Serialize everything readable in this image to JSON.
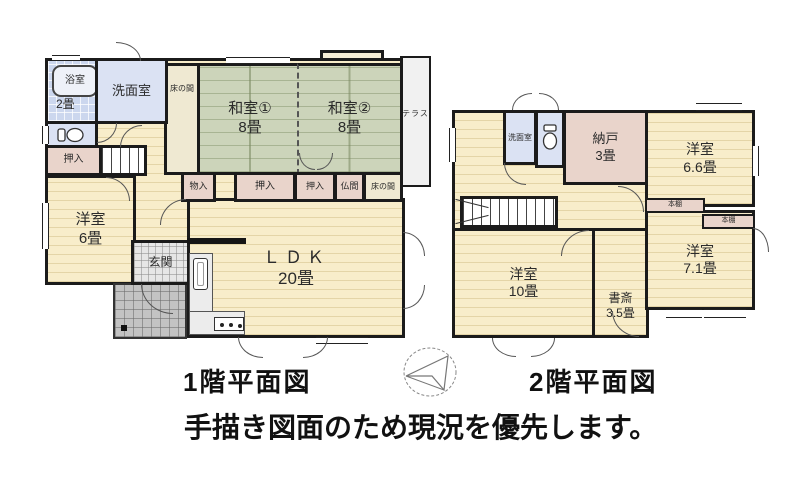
{
  "meta": {
    "type": "hand-drawn real-estate floor plan, two storeys"
  },
  "colors": {
    "wall": "#1b1b1b",
    "room_cream": "#f8edca",
    "tatami_green": "#ccd4ba",
    "water_blue": "#dbe2f3",
    "closet_pink": "#e9d4cb",
    "entrance_gray": "#e6e6e6",
    "porch_gray": "#c3c3c3",
    "terrace_gray": "#f1f1f1"
  },
  "icons": {
    "compass-icon": "hand-drawn circle with north arrow",
    "bathtub-icon": "rounded bathtub outline",
    "toilet-icon": "toilet tank and bowl",
    "kitchen-sink-icon": "kitchen sink basin",
    "stove-icon": "cooktop with three burners"
  },
  "floor1": {
    "title": "1階平面図",
    "rooms": {
      "bathroom": {
        "label": "浴室",
        "size": "2畳"
      },
      "washroom": {
        "label": "洗面室"
      },
      "tokonoma_upper": {
        "label": "床の間"
      },
      "washitsu1": {
        "label": "和室①",
        "size": "8畳"
      },
      "washitsu2": {
        "label": "和室②",
        "size": "8畳"
      },
      "terrace": {
        "label": "テラス"
      },
      "oshiire_west": {
        "label": "押入"
      },
      "monoire": {
        "label": "物入"
      },
      "oshiire_center": {
        "label": "押入"
      },
      "oshiire_east": {
        "label": "押入"
      },
      "butsuma": {
        "label": "仏間"
      },
      "tokonoma_lower": {
        "label": "床の間"
      },
      "yoshitsu6": {
        "label": "洋室",
        "size": "6畳"
      },
      "genkan": {
        "label": "玄関"
      },
      "ldk": {
        "label": "ＬＤＫ",
        "size": "20畳"
      }
    }
  },
  "floor2": {
    "title": "2階平面図",
    "rooms": {
      "washroom": {
        "label": "洗面室"
      },
      "nando": {
        "label": "納戸",
        "size": "3畳"
      },
      "yoshitsu66": {
        "label": "洋室",
        "size": "6.6畳"
      },
      "bookshelf_north": {
        "label": "本棚"
      },
      "bookshelf_south": {
        "label": "本棚"
      },
      "yoshitsu71": {
        "label": "洋室",
        "size": "7.1畳"
      },
      "yoshitsu10": {
        "label": "洋室",
        "size": "10畳"
      },
      "shosai": {
        "label": "書斎",
        "size": "3.5畳"
      }
    }
  },
  "footer": {
    "note": "手描き図面のため現況を優先します。"
  }
}
